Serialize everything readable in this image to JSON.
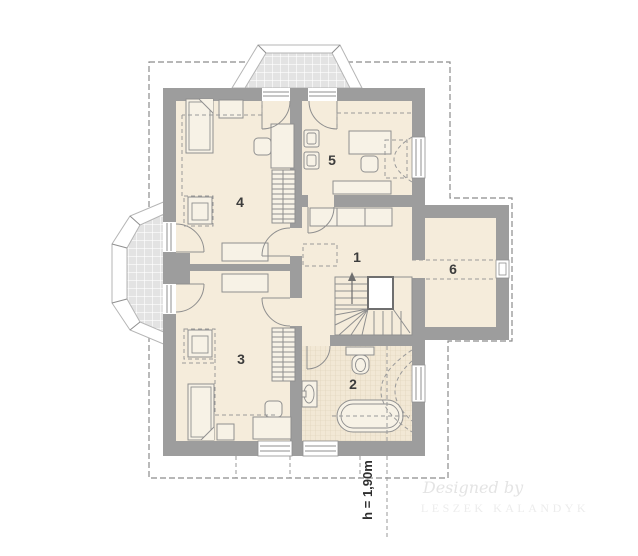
{
  "document": {
    "type": "attic-floor-plan-drawing",
    "room_labels": [
      "1",
      "2",
      "3",
      "4",
      "5",
      "6"
    ],
    "height_annotation": "h = 1,90m",
    "watermark": {
      "line1": "Designed by",
      "line2": "LESZEK KALANDYK"
    },
    "colors": {
      "wall": "#9d9d9d",
      "floor": "#f5ecdb",
      "balcony_tile": "#e3e3e3",
      "bath_tile": "#f2e8d5",
      "outline": "#8f8f8f",
      "dashed_line": "#9a9a9a",
      "label": "#3c3c3c",
      "watermark": "#e6e6e6"
    }
  }
}
